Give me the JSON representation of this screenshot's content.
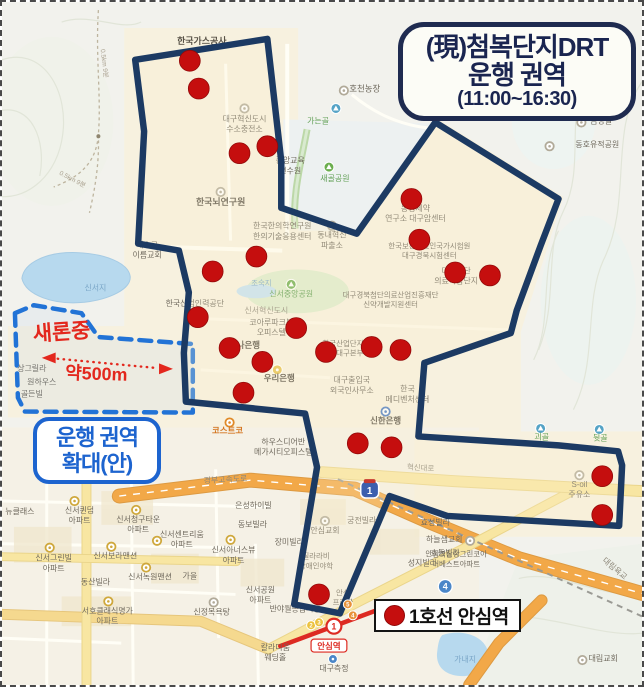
{
  "title_box": {
    "line1": "(現)첨복단지DRT",
    "line2": "운행 권역",
    "line3": "(11:00~16:30)"
  },
  "legend": {
    "label": "1호선 안심역"
  },
  "expansion_box": {
    "line1": "운행 권역",
    "line2": "확대(안)"
  },
  "annotations": {
    "school": "새론중",
    "distance": "약500m",
    "arrow": {
      "x1": 42,
      "y1": 358,
      "x2": 170,
      "y2": 369
    }
  },
  "palette": {
    "zone_navy": "#1c3a63",
    "stop_red": "#c50e0e",
    "stop_edge": "#930909",
    "dash_blue": "#2273d6",
    "annotation_red": "#e3271d",
    "box_blue": "#1d64cf",
    "highway_orange": "#f2a848",
    "road_yellow": "#f8e6a2",
    "water_blue": "#b7d9ee",
    "label_g": "#6f695d",
    "label_G": "#8e887a",
    "label_b": "#7ba7c8",
    "label_n": "#5f9e53",
    "label_o": "#d4761f",
    "label_t": "#a89f8d",
    "label_d": "#575146"
  },
  "map": {
    "zone_current": [
      [
        134,
        58
      ],
      [
        267,
        37
      ],
      [
        281,
        160
      ],
      [
        281,
        207
      ],
      [
        357,
        233
      ],
      [
        436,
        121
      ],
      [
        560,
        198
      ],
      [
        542,
        245
      ],
      [
        518,
        310
      ],
      [
        512,
        333
      ],
      [
        425,
        363
      ],
      [
        419,
        437
      ],
      [
        560,
        446
      ],
      [
        620,
        452
      ],
      [
        624,
        466
      ],
      [
        621,
        527
      ],
      [
        448,
        517
      ],
      [
        390,
        497
      ],
      [
        340,
        615
      ],
      [
        294,
        606
      ],
      [
        317,
        468
      ],
      [
        305,
        414
      ],
      [
        185,
        402
      ],
      [
        183,
        353
      ],
      [
        188,
        292
      ],
      [
        178,
        250
      ],
      [
        137,
        243
      ],
      [
        143,
        130
      ]
    ],
    "zone_proposed": [
      [
        13,
        313
      ],
      [
        32,
        305
      ],
      [
        80,
        313
      ],
      [
        97,
        337
      ],
      [
        192,
        344
      ],
      [
        192,
        413
      ],
      [
        23,
        412
      ],
      [
        16,
        398
      ]
    ],
    "stops": [
      [
        189,
        59
      ],
      [
        198,
        87
      ],
      [
        239,
        152
      ],
      [
        267,
        145
      ],
      [
        412,
        198
      ],
      [
        420,
        239
      ],
      [
        456,
        272
      ],
      [
        491,
        275
      ],
      [
        256,
        256
      ],
      [
        212,
        271
      ],
      [
        197,
        317
      ],
      [
        296,
        328
      ],
      [
        229,
        348
      ],
      [
        262,
        362
      ],
      [
        326,
        352
      ],
      [
        372,
        347
      ],
      [
        401,
        350
      ],
      [
        243,
        393
      ],
      [
        358,
        444
      ],
      [
        392,
        448
      ],
      [
        604,
        477
      ],
      [
        604,
        516
      ],
      [
        319,
        596
      ]
    ],
    "roads": [
      {
        "pts": [
          [
            118,
            497
          ],
          [
            250,
            481
          ],
          [
            355,
            490
          ],
          [
            430,
            523
          ],
          [
            520,
            560
          ],
          [
            644,
            595
          ]
        ],
        "w": 13,
        "c": "#f2a848",
        "edge": "#dd9a42",
        "center": true
      },
      {
        "pts": [
          [
            470,
            687
          ],
          [
            500,
            645
          ],
          [
            543,
            602
          ]
        ],
        "w": 10,
        "c": "#f2a848",
        "edge": "#dd9a42"
      },
      {
        "pts": [
          [
            0,
            616
          ],
          [
            200,
            623
          ],
          [
            268,
            651
          ]
        ],
        "w": 9,
        "c": "#f5d98f",
        "edge": "#e6c67c"
      },
      {
        "pts": [
          [
            268,
            651
          ],
          [
            360,
            603
          ],
          [
            470,
            547
          ],
          [
            572,
            493
          ]
        ],
        "w": 8,
        "c": "#f8e6a2",
        "edge": "#ead58b"
      },
      {
        "pts": [
          [
            322,
            473
          ],
          [
            455,
            482
          ],
          [
            643,
            492
          ]
        ],
        "w": 10,
        "c": "#f8e6a2",
        "edge": "#ead58b"
      },
      {
        "pts": [
          [
            85,
            470
          ],
          [
            85,
            687
          ]
        ],
        "w": 8,
        "c": "#f8e6a2",
        "edge": "#ead58b"
      },
      {
        "pts": [
          [
            0,
            558
          ],
          [
            236,
            563
          ]
        ],
        "w": 7,
        "c": "#f8e6a2",
        "edge": "#ead58b"
      }
    ],
    "railway": [
      [
        338,
        480
      ],
      [
        644,
        618
      ]
    ],
    "subway": [
      [
        280,
        648
      ],
      [
        385,
        609
      ]
    ],
    "subway_badge": {
      "t": "1",
      "x": 334,
      "y": 628
    },
    "station": {
      "name": "안심역",
      "x": 329,
      "y": 647
    },
    "shields": [
      {
        "t": "1",
        "x": 370,
        "y": 491,
        "k": "expwy"
      },
      {
        "t": "4",
        "x": 446,
        "y": 588,
        "k": "blue"
      },
      {
        "t": "2",
        "x": 311,
        "y": 627,
        "k": "miny"
      },
      {
        "t": "3",
        "x": 319,
        "y": 624,
        "k": "miny"
      },
      {
        "t": "5",
        "x": 348,
        "y": 606,
        "k": "mino"
      },
      {
        "t": "4",
        "x": 353,
        "y": 617,
        "k": "mino"
      }
    ],
    "labels": [
      {
        "t": "한국가스공사",
        "x": 201,
        "y": 42,
        "s": 9,
        "c": "d"
      },
      {
        "t": "호천농장",
        "x": 365,
        "y": 90,
        "s": 8.5,
        "i": [
          344,
          89,
          "gray"
        ]
      },
      {
        "t": "가는골",
        "x": 318,
        "y": 122,
        "c": "n",
        "i": [
          336,
          107,
          "mtn"
        ]
      },
      {
        "t": "금방골",
        "x": 603,
        "y": 122,
        "i": [
          583,
          121,
          "gray"
        ]
      },
      {
        "t": "동호유적공원",
        "x": 599,
        "y": 146,
        "i": [
          551,
          145,
          "gray"
        ]
      },
      {
        "t": "대구혁신도시\n수소충전소",
        "x": 244,
        "y": 120,
        "i": [
          244,
          107,
          "gray"
        ]
      },
      {
        "t": "중앙교육\n연수원",
        "x": 290,
        "y": 162
      },
      {
        "t": "새골공원",
        "x": 335,
        "y": 180,
        "c": "n",
        "i": [
          329,
          166,
          "park"
        ]
      },
      {
        "t": "한국뇌연구원",
        "x": 220,
        "y": 204,
        "s": 9,
        "c": "d",
        "i": [
          220,
          191,
          "gray"
        ]
      },
      {
        "t": "한국한의학연구원\n한의기술응용센터",
        "x": 282,
        "y": 228
      },
      {
        "t": "동내혁신\n파출소",
        "x": 332,
        "y": 237,
        "i": [
          332,
          225,
          "gray"
        ]
      },
      {
        "t": "예수그\n이름교회",
        "x": 146,
        "y": 247
      },
      {
        "t": "신서지",
        "x": 94,
        "y": 290,
        "c": "b"
      },
      {
        "t": "동성제약\n연구소 대구암센터",
        "x": 416,
        "y": 210
      },
      {
        "t": "한국보건의료인국가시험원\n대구경북시험센터",
        "x": 430,
        "y": 248,
        "s": 7.5
      },
      {
        "t": "대구경북첨단의료산업진흥재단\n신약개발지원센터",
        "x": 391,
        "y": 297,
        "s": 7.5
      },
      {
        "t": "대구첨단\n의료복합단지",
        "x": 457,
        "y": 273
      },
      {
        "t": "조숙지",
        "x": 261,
        "y": 285,
        "c": "b",
        "s": 7.5
      },
      {
        "t": "신서중앙공원",
        "x": 291,
        "y": 296,
        "c": "n",
        "i": [
          291,
          284,
          "park"
        ]
      },
      {
        "t": "신서혁신도시",
        "x": 266,
        "y": 313,
        "c": "G"
      },
      {
        "t": "한국산업인력공단",
        "x": 194,
        "y": 306
      },
      {
        "t": "코아루파크뷰\n오피스텔",
        "x": 271,
        "y": 325
      },
      {
        "t": "하나은행",
        "x": 244,
        "y": 348,
        "s": 8.5,
        "c": "d"
      },
      {
        "t": "우리은행",
        "x": 279,
        "y": 381,
        "s": 8.5,
        "c": "d",
        "i": [
          277,
          370,
          "bank"
        ]
      },
      {
        "t": "한국산업단지공단\n대구본부",
        "x": 350,
        "y": 346,
        "s": 7.5
      },
      {
        "t": "대구출입국\n외국인사무소",
        "x": 352,
        "y": 383
      },
      {
        "t": "한국\n메디벤처센터",
        "x": 408,
        "y": 392
      },
      {
        "t": "신한은행",
        "x": 386,
        "y": 424,
        "s": 8.5,
        "c": "d",
        "i": [
          386,
          412,
          "shinhan"
        ]
      },
      {
        "t": "코스트코",
        "x": 227,
        "y": 434,
        "s": 8.5,
        "c": "o",
        "i": [
          229,
          423,
          "costco"
        ]
      },
      {
        "t": "하우스디어반\n메가시티오피스텔",
        "x": 283,
        "y": 445
      },
      {
        "t": "혁신대로",
        "x": 421,
        "y": 471,
        "s": 7.5,
        "c": "G",
        "r": 4
      },
      {
        "t": "S-oil\n주유소",
        "x": 581,
        "y": 488,
        "i": [
          581,
          476,
          "gray"
        ]
      },
      {
        "t": "괴골",
        "x": 543,
        "y": 440,
        "c": "n",
        "i": [
          542,
          429,
          "mtn"
        ]
      },
      {
        "t": "뒷골",
        "x": 602,
        "y": 441,
        "c": "n",
        "i": [
          601,
          430,
          "mtn"
        ]
      },
      {
        "t": "경부고속도로",
        "x": 225,
        "y": 483,
        "c": "G",
        "r": -3
      },
      {
        "t": "대림육교",
        "x": 615,
        "y": 572,
        "c": "G",
        "r": 40
      },
      {
        "t": "은성하이빌",
        "x": 253,
        "y": 509
      },
      {
        "t": "동보빌라",
        "x": 252,
        "y": 528
      },
      {
        "t": "장미빌라",
        "x": 289,
        "y": 546
      },
      {
        "t": "궁전빌라",
        "x": 362,
        "y": 524
      },
      {
        "t": "안심교회",
        "x": 325,
        "y": 534,
        "i": [
          325,
          522,
          "gray"
        ]
      },
      {
        "t": "효성빌라",
        "x": 436,
        "y": 526
      },
      {
        "t": "하늘샘교회",
        "x": 445,
        "y": 543,
        "i": [
          471,
          542,
          "gray"
        ]
      },
      {
        "t": "효동빌라",
        "x": 446,
        "y": 557
      },
      {
        "t": "성지빌라",
        "x": 423,
        "y": 567
      },
      {
        "t": "안심역삼정그린코아\n더베스트아파트",
        "x": 457,
        "y": 558,
        "s": 7.5
      },
      {
        "t": "신서퀸덤\n아파트",
        "x": 78,
        "y": 514,
        "i": [
          73,
          502,
          "apt"
        ]
      },
      {
        "t": "신서청구타운\n아파트",
        "x": 137,
        "y": 523,
        "i": [
          135,
          511,
          "apt"
        ]
      },
      {
        "t": "신서센트리움\n아파트",
        "x": 181,
        "y": 538,
        "i": [
          156,
          542,
          "apt"
        ]
      },
      {
        "t": "신서아너스뷰\n아파트",
        "x": 233,
        "y": 554,
        "i": [
          230,
          541,
          "apt"
        ]
      },
      {
        "t": "신서그린빌\n아파트",
        "x": 52,
        "y": 562,
        "i": [
          48,
          549,
          "apt"
        ]
      },
      {
        "t": "신서보라맨션",
        "x": 114,
        "y": 560,
        "i": [
          110,
          548,
          "apt"
        ]
      },
      {
        "t": "신서녹원맨션",
        "x": 149,
        "y": 581,
        "i": [
          145,
          569,
          "apt"
        ]
      },
      {
        "t": "가을",
        "x": 189,
        "y": 580
      },
      {
        "t": "동산빌라",
        "x": 94,
        "y": 586
      },
      {
        "t": "서호클래식명가\n아파트",
        "x": 106,
        "y": 615,
        "i": [
          107,
          603,
          "apt"
        ]
      },
      {
        "t": "신정목욕탕",
        "x": 211,
        "y": 616,
        "i": [
          213,
          604,
          "gray"
        ]
      },
      {
        "t": "신서공원\n아파트",
        "x": 260,
        "y": 594
      },
      {
        "t": "반야월종합시장",
        "x": 295,
        "y": 613
      },
      {
        "t": "뉴클래스",
        "x": 18,
        "y": 515
      },
      {
        "t": "칼라디움\n웨딩홀",
        "x": 275,
        "y": 652
      },
      {
        "t": "대구측정",
        "x": 334,
        "y": 673,
        "i": [
          333,
          661,
          "spot"
        ]
      },
      {
        "t": "가내지",
        "x": 466,
        "y": 664,
        "c": "b"
      },
      {
        "t": "대림교회",
        "x": 605,
        "y": 663,
        "i": [
          584,
          662,
          "gray"
        ]
      },
      {
        "t": "상그릴라",
        "x": 30,
        "y": 371
      },
      {
        "t": "원하우스",
        "x": 40,
        "y": 385
      },
      {
        "t": "골든빌",
        "x": 30,
        "y": 397
      },
      {
        "t": "질라라비\n장애인야학",
        "x": 316,
        "y": 560,
        "s": 7.5
      },
      {
        "t": "안심\n프라자",
        "x": 343,
        "y": 597,
        "s": 7.5
      },
      {
        "t": "0.5km 9분",
        "x": 101,
        "y": 62,
        "s": 6.5,
        "c": "t",
        "r": 83
      },
      {
        "t": "0.5km 9분",
        "x": 70,
        "y": 180,
        "s": 6.5,
        "c": "t",
        "r": 28
      }
    ]
  }
}
